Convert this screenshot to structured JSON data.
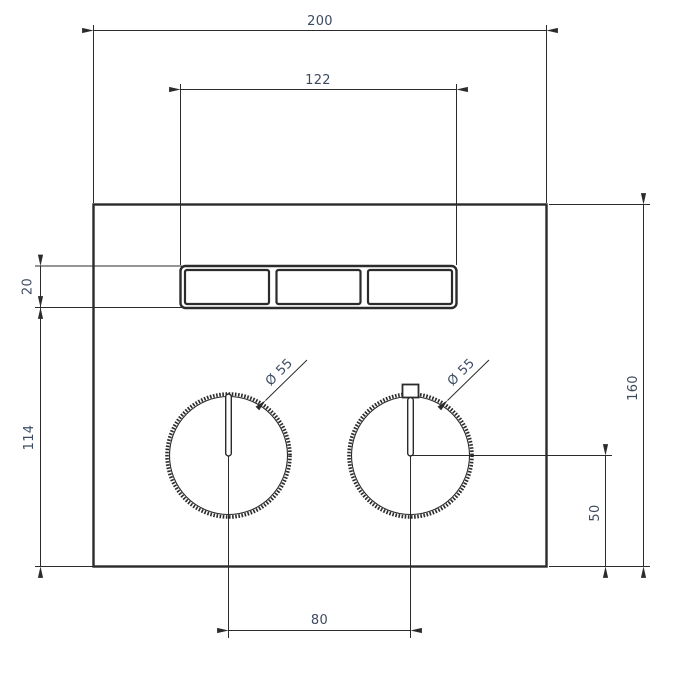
{
  "drawing": {
    "type": "technical-dimension-drawing",
    "subject": "thermostatic-mixer-front-plate-with-3-buttons-and-2-knobs",
    "colors": {
      "line": "#2b2b2b",
      "dim_text": "#3d4b61",
      "background": "#ffffff"
    },
    "dimensions": {
      "overall_width": "200",
      "button_group_width": "122",
      "button_row_height": "20",
      "height_below_buttons": "114",
      "overall_height": "160",
      "knob_center_to_bottom": "50",
      "knob_spacing": "80",
      "left_knob_diameter": "Ø 55",
      "right_knob_diameter": "Ø 55"
    }
  }
}
